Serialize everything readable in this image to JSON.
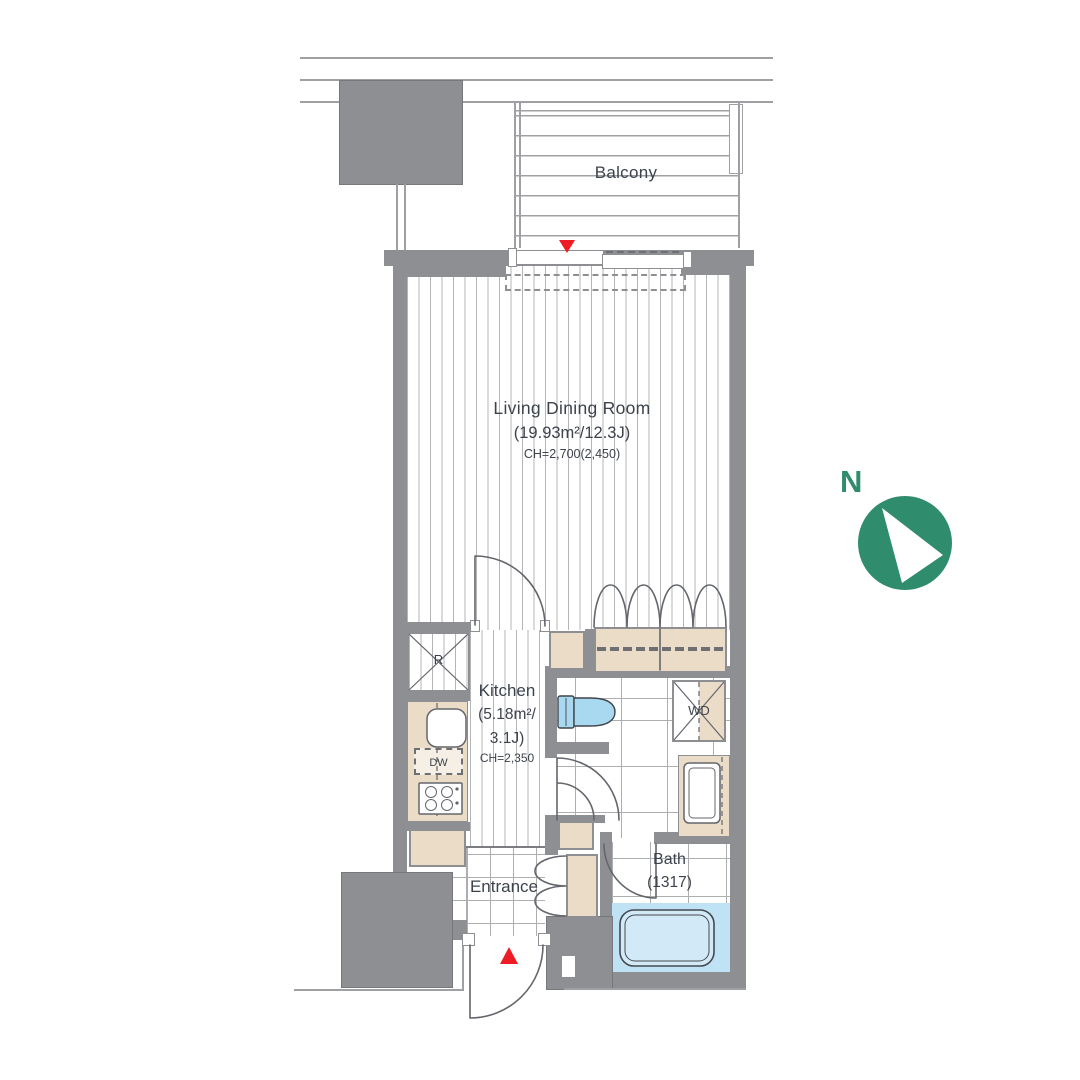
{
  "rooms": {
    "balcony": {
      "name": "Balcony"
    },
    "living": {
      "name": "Living Dining Room",
      "area": "(19.93m²/12.3J)",
      "ceiling": "CH=2,700(2,450)"
    },
    "kitchen": {
      "name": "Kitchen",
      "area_line1": "(5.18m²/",
      "area_line2": "3.1J)",
      "ceiling": "CH=2,350"
    },
    "entrance": {
      "name": "Entrance"
    },
    "bath": {
      "name": "Bath",
      "size": "(1317)"
    }
  },
  "fixtures": {
    "refrigerator_label": "R",
    "dishwasher_label": "DW",
    "washer_dryer_label": "WD"
  },
  "compass": {
    "north_label": "N"
  },
  "colors": {
    "wall": "#8E8F93",
    "line": "#9EA0A3",
    "lineDark": "#63666C",
    "stripe": "#B4B5B7",
    "grid": "#ADAEB0",
    "beige": "#EBDCC8",
    "blueZone": "#BFE3F4",
    "fixtureBlue": "#A9D9F0",
    "tubFill": "#D2EAF8",
    "green": "#2F8C6D",
    "red": "#EE1C25",
    "text": "#3D434C",
    "dash": "#6E6F72"
  }
}
